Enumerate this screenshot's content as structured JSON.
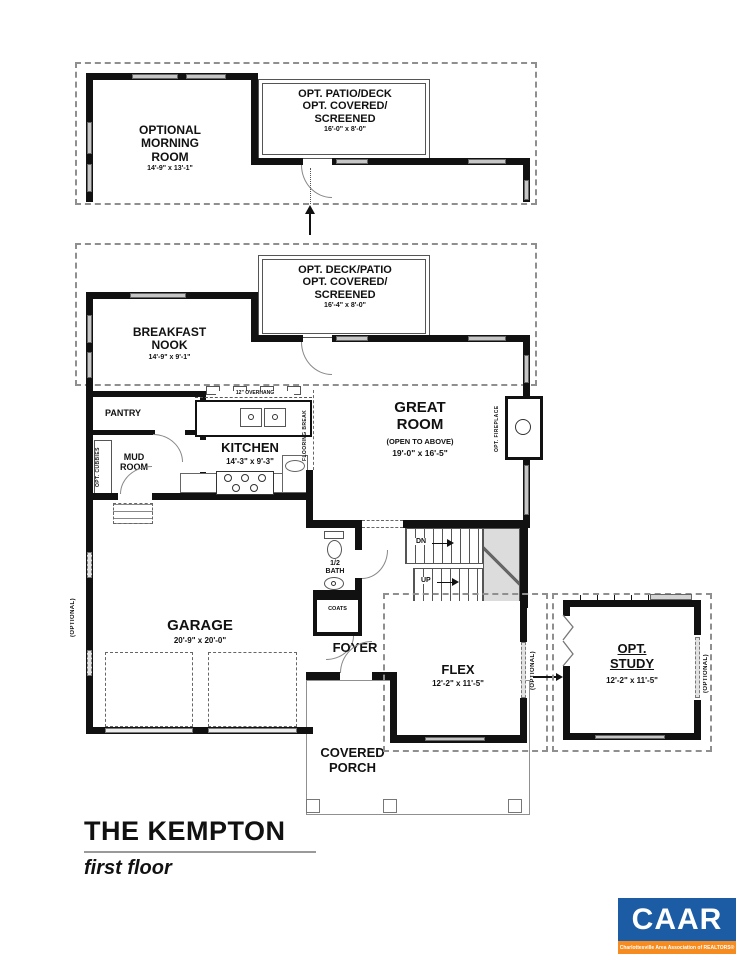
{
  "plan": {
    "sections": {
      "morning_room": {
        "name": "OPTIONAL\nMORNING\nROOM",
        "dims": "14'-9\" x 13'-1\""
      },
      "patio_top": {
        "name": "OPT. PATIO/DECK\nOPT. COVERED/\nSCREENED",
        "dims": "16'-0\" x 8'-0\""
      },
      "deck_patio": {
        "name": "OPT. DECK/PATIO\nOPT. COVERED/\nSCREENED",
        "dims": "16'-4\" x 8'-0\""
      },
      "breakfast_nook": {
        "name": "BREAKFAST\nNOOK",
        "dims": "14'-9\" x 9'-1\""
      },
      "kitchen": {
        "name": "KITCHEN",
        "dims": "14'-3\" x 9'-3\""
      },
      "great_room": {
        "name": "GREAT\nROOM",
        "note": "(OPEN TO ABOVE)",
        "dims": "19'-0\" x 16'-5\""
      },
      "pantry": {
        "name": "PANTRY"
      },
      "mud_room": {
        "name": "MUD\nROOM"
      },
      "garage": {
        "name": "GARAGE",
        "dims": "20'-9\" x 20'-0\""
      },
      "half_bath": {
        "name": "1/2\nBATH"
      },
      "coats": {
        "name": "COATS"
      },
      "foyer": {
        "name": "FOYER"
      },
      "flex": {
        "name": "FLEX",
        "dims": "12'-2\" x 11'-5\""
      },
      "study": {
        "name": "OPT.\nSTUDY",
        "dims": "12'-2\" x 11'-5\""
      },
      "porch": {
        "name": "COVERED\nPORCH"
      }
    },
    "annotations": {
      "opt_cubbies": "OPT. CUBBIES",
      "flooring_break": "FLOORING BREAK",
      "overhang": "12\" OVERHANG",
      "opt_fireplace": "OPT. FIREPLACE",
      "optional_left": "(OPTIONAL)",
      "optional_flex": "(OPTIONAL)",
      "optional_study": "(OPTIONAL)",
      "dn": "DN",
      "up": "UP"
    }
  },
  "title": {
    "name": "THE KEMPTON",
    "subtitle": "first floor"
  },
  "logo": {
    "text": "CAAR",
    "tagline": "Charlottesville Area Association of REALTORS®",
    "blue": "#1c5ca5",
    "orange": "#f68b1f"
  }
}
